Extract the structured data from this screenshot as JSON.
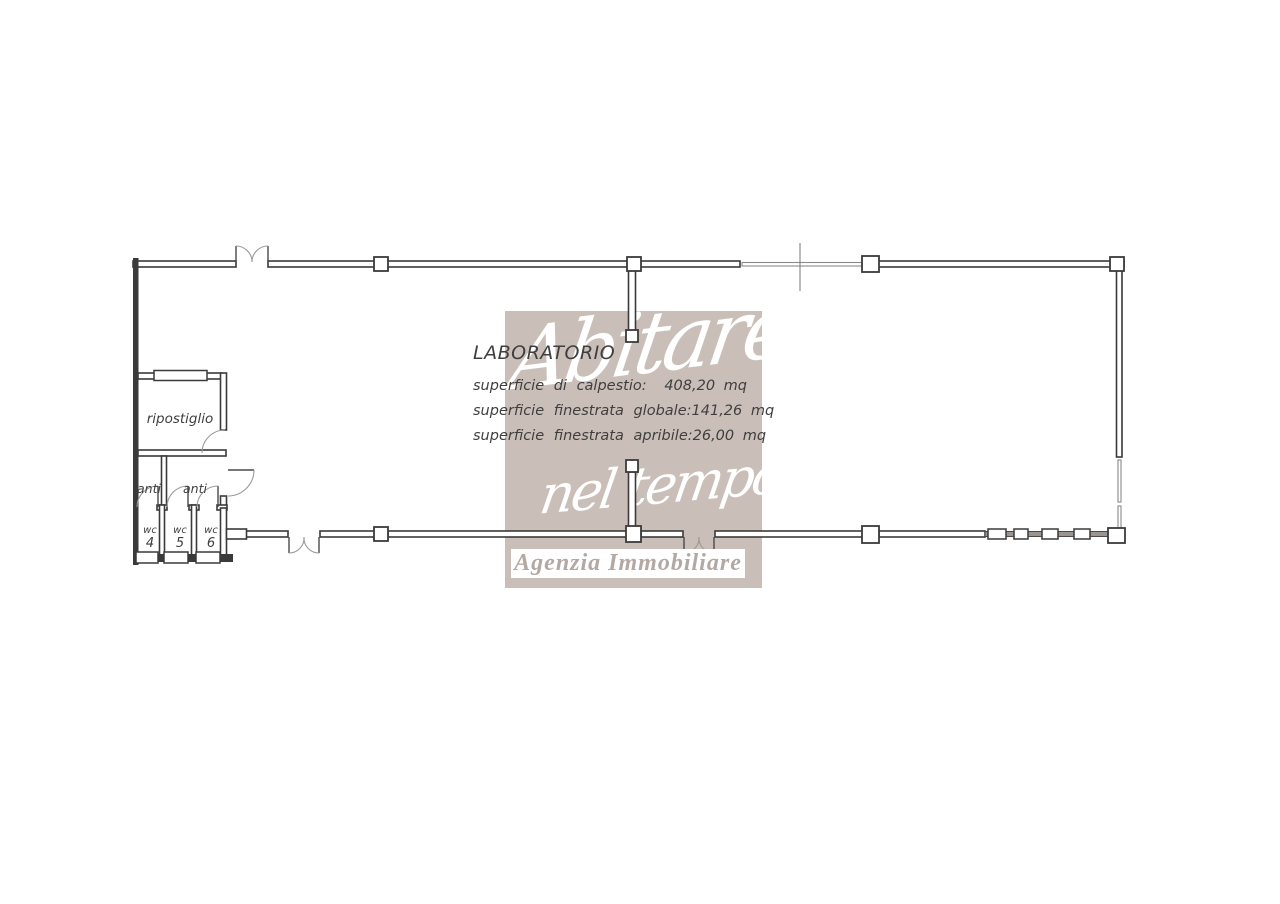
{
  "plan": {
    "title_block": {
      "title": "LABORATORIO",
      "rows": [
        {
          "label": "superficie di calpestio:",
          "value": "408,20 mq"
        },
        {
          "label": "superficie finestrata globale:",
          "value": "141,26 mq"
        },
        {
          "label": "superficie finestrata apribile:",
          "value": "26,00 mq"
        }
      ]
    },
    "rooms": {
      "ripostiglio": "ripostiglio",
      "anti1": "anti",
      "anti2": "anti",
      "wc4": {
        "label": "wc",
        "number": "4"
      },
      "wc5": {
        "label": "wc",
        "number": "5"
      },
      "wc6": {
        "label": "wc",
        "number": "6"
      }
    }
  },
  "watermark": {
    "line1": "Abitare",
    "line2": "nel tempo",
    "banner": "Agenzia Immobiliare",
    "bg_color": "#c9bfb8",
    "script_color": "#ffffff",
    "banner_bg": "#ffffff",
    "banner_text_color": "#b3a8a2"
  },
  "colors": {
    "wall": "#3a3a3a",
    "window_line": "#8a8a8a",
    "door_arc": "#9a9a9a",
    "plan_text": "#3f3f3f",
    "background": "#ffffff"
  }
}
